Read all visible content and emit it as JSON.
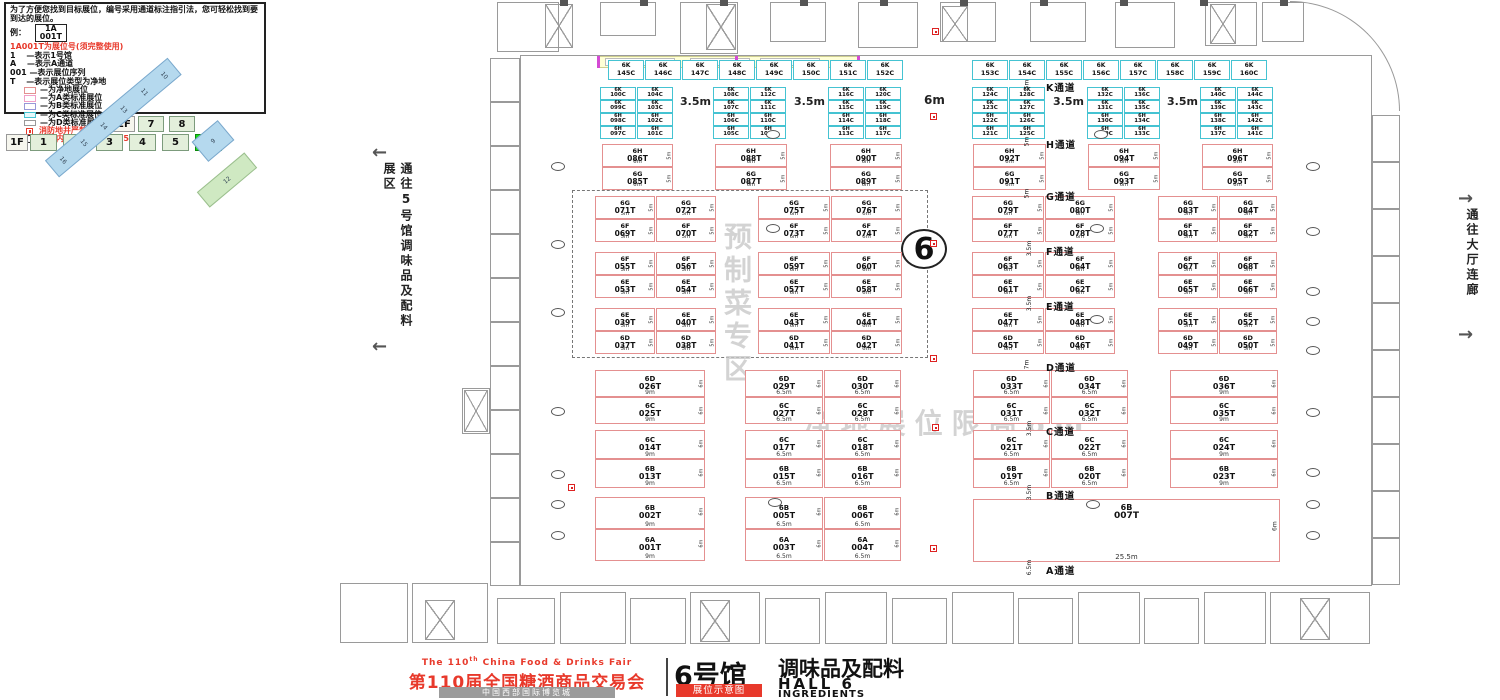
{
  "legend": {
    "intro": "为了方便您找到目标展位，编号采用通道标注指引法，您可轻松找到要到达的展位。",
    "example_label": "例：",
    "example_top": "1A",
    "example_bottom": "001T",
    "rule_title": "1A001T为展位号(须完整使用)",
    "rules": [
      "1　 —表示1号馆",
      "A　 —表示A通道",
      "001 —表示展位序列",
      "T　 —表示展位类型为净地"
    ],
    "swatches": [
      {
        "label": "—为净地展位",
        "border": "#e49090",
        "bg": "#ffffff"
      },
      {
        "label": "—为A类标准展位",
        "border": "#f0a0c8",
        "bg": "#ffffff"
      },
      {
        "label": "—为B类标准展位",
        "border": "#9898d8",
        "bg": "#ffffff"
      },
      {
        "label": "—为C类标准展位",
        "border": "#45c3d2",
        "bg": "#e4f9fb"
      },
      {
        "label": "—为D类标准展位",
        "border": "#999999",
        "bg": "#ffffff"
      }
    ],
    "fire_note": "消防地井严禁遮挡",
    "pillar_note": "展位内立柱 直径均为1.5m"
  },
  "floor_selector": {
    "f2_label": "2F",
    "f2_tabs": [
      "7",
      "8"
    ],
    "f1_label": "1F",
    "f1_tabs": [
      "1",
      "2",
      "3",
      "4",
      "5",
      "6"
    ],
    "active": "6"
  },
  "minimap": {
    "bar_labels": [
      "16",
      "15",
      "14",
      "13",
      "11",
      "10"
    ],
    "diamond_label": "9",
    "green_label": "12"
  },
  "side_labels": {
    "left": "通往5号馆调味品及配料展区",
    "right": "通往大厅连廊"
  },
  "watermarks": {
    "zone": "预制菜专区",
    "limit": "净地展位限高6m"
  },
  "hall_circle": "6",
  "footer": {
    "fair_en_a": "The 110",
    "fair_en_sup": "th",
    "fair_en_b": " China Food & Drinks Fair",
    "fair_cn": "第110届全国糖酒商品交易会",
    "venue": "中国西部国际博览城",
    "hall_cn": "6号馆",
    "hall_sub": "调味品及配料",
    "badge": "展位示意图",
    "hall_en": "HALL 6",
    "hall_en2": "INGREDIENTS"
  },
  "plan": {
    "cyan_top": {
      "y": 60,
      "h": 20,
      "w": 36,
      "gap": 1,
      "rows": [
        {
          "x": 608,
          "ids": [
            "6K 145C",
            "6K 146C",
            "6K 147C",
            "6K 148C",
            "6K 149C",
            "6K 150C",
            "6K 151C",
            "6K 152C"
          ]
        },
        {
          "x": 972,
          "ids": [
            "6K 153C",
            "6K 154C",
            "6K 155C",
            "6K 156C",
            "6K 157C",
            "6K 158C",
            "6K 159C",
            "6K 160C"
          ]
        }
      ]
    },
    "cyan_groups": {
      "y": 87,
      "rowH": 13,
      "colW": 36,
      "gap": 1,
      "groups": [
        {
          "x": 600,
          "cells": [
            [
              "6K 100C",
              "6K 104C"
            ],
            [
              "6K 099C",
              "6K 103C"
            ],
            [
              "6H 098C",
              "6H 102C"
            ],
            [
              "6H 097C",
              "6H 101C"
            ]
          ]
        },
        {
          "x": 713,
          "cells": [
            [
              "6K 108C",
              "6K 112C"
            ],
            [
              "6K 107C",
              "6K 111C"
            ],
            [
              "6H 106C",
              "6H 110C"
            ],
            [
              "6H 105C",
              "6H 109C"
            ]
          ]
        },
        {
          "x": 828,
          "cells": [
            [
              "6K 116C",
              "6K 120C"
            ],
            [
              "6K 115C",
              "6K 119C"
            ],
            [
              "6H 114C",
              "6H 118C"
            ],
            [
              "6H 113C",
              "6H 117C"
            ]
          ]
        },
        {
          "x": 972,
          "cells": [
            [
              "6K 124C",
              "6K 128C"
            ],
            [
              "6K 123C",
              "6K 127C"
            ],
            [
              "6H 122C",
              "6H 126C"
            ],
            [
              "6H 121C",
              "6H 125C"
            ]
          ]
        },
        {
          "x": 1087,
          "cells": [
            [
              "6K 132C",
              "6K 136C"
            ],
            [
              "6K 131C",
              "6K 135C"
            ],
            [
              "6H 130C",
              "6H 134C"
            ],
            [
              "6H 129C",
              "6H 133C"
            ]
          ]
        },
        {
          "x": 1200,
          "cells": [
            [
              "6K 140C",
              "6K 144C"
            ],
            [
              "6K 139C",
              "6K 143C"
            ],
            [
              "6H 138C",
              "6H 142C"
            ],
            [
              "6H 137C",
              "6H 141C"
            ]
          ]
        }
      ]
    },
    "gap_dims": [
      {
        "x": 680,
        "y": 95,
        "t": "3.5m"
      },
      {
        "x": 794,
        "y": 95,
        "t": "3.5m"
      },
      {
        "x": 924,
        "y": 93,
        "t": "6m"
      },
      {
        "x": 1053,
        "y": 95,
        "t": "3.5m"
      },
      {
        "x": 1167,
        "y": 95,
        "t": "3.5m"
      }
    ],
    "red_bands": [
      {
        "y": 144,
        "cellH": 23,
        "cols": [
          [
            602,
            71,
            "6H 086T",
            "6G 085T",
            "6m",
            "5m"
          ],
          [
            715,
            72,
            "6H 088T",
            "6G 087T",
            "6m",
            "5m"
          ],
          [
            830,
            72,
            "6H 090T",
            "6G 089T",
            "6m",
            "5m"
          ],
          [
            973,
            73,
            "6H 092T",
            "6G 091T",
            "6m",
            "5m"
          ],
          [
            1088,
            72,
            "6H 094T",
            "6G 093T",
            "6m",
            "5m"
          ],
          [
            1202,
            71,
            "6H 096T",
            "6G 095T",
            "6m",
            "5m"
          ]
        ]
      },
      {
        "y": 196,
        "cellH": 23,
        "cols": [
          [
            595,
            60,
            "6G 071T",
            "6F 069T",
            "5m",
            "5m"
          ],
          [
            656,
            60,
            "6G 072T",
            "6F 070T",
            "5m",
            "5m"
          ],
          [
            758,
            72,
            "6G 075T",
            "6F 073T",
            "6m",
            "5m"
          ],
          [
            831,
            71,
            "6G 076T",
            "6F 074T",
            "6m",
            "5m"
          ],
          [
            972,
            72,
            "6G 079T",
            "6F 077T",
            "6m",
            "5m"
          ],
          [
            1045,
            70,
            "6G 080T",
            "6F 078T",
            "6m",
            "5m"
          ],
          [
            1158,
            60,
            "6G 083T",
            "6F 081T",
            "5m",
            "5m"
          ],
          [
            1219,
            58,
            "6G 084T",
            "6F 082T",
            "5m",
            "5m"
          ]
        ]
      },
      {
        "y": 252,
        "cellH": 23,
        "cols": [
          [
            595,
            60,
            "6F 055T",
            "6E 053T",
            "5m",
            "5m"
          ],
          [
            656,
            60,
            "6F 056T",
            "6E 054T",
            "5m",
            "5m"
          ],
          [
            758,
            72,
            "6F 059T",
            "6E 057T",
            "6m",
            "5m"
          ],
          [
            831,
            71,
            "6F 060T",
            "6E 058T",
            "6m",
            "5m"
          ],
          [
            972,
            72,
            "6F 063T",
            "6E 061T",
            "6m",
            "5m"
          ],
          [
            1045,
            70,
            "6F 064T",
            "6E 062T",
            "6m",
            "5m"
          ],
          [
            1158,
            60,
            "6F 067T",
            "6E 065T",
            "5m",
            "5m"
          ],
          [
            1219,
            58,
            "6F 068T",
            "6E 066T",
            "5m",
            "5m"
          ]
        ]
      },
      {
        "y": 308,
        "cellH": 23,
        "cols": [
          [
            595,
            60,
            "6E 039T",
            "6D 037T",
            "5m",
            "5m"
          ],
          [
            656,
            60,
            "6E 040T",
            "6D 038T",
            "5m",
            "5m"
          ],
          [
            758,
            72,
            "6E 043T",
            "6D 041T",
            "6m",
            "5m"
          ],
          [
            831,
            71,
            "6E 044T",
            "6D 042T",
            "6m",
            "5m"
          ],
          [
            972,
            72,
            "6E 047T",
            "6D 045T",
            "6m",
            "5m"
          ],
          [
            1045,
            70,
            "6E 048T",
            "6D 046T",
            "6m",
            "5m"
          ],
          [
            1158,
            60,
            "6E 051T",
            "6D 049T",
            "5m",
            "5m"
          ],
          [
            1219,
            58,
            "6E 052T",
            "6D 050T",
            "5m",
            "5m"
          ]
        ]
      },
      {
        "y": 370,
        "cellH": 27,
        "cols": [
          [
            595,
            110,
            "6D 026T",
            "6C 025T",
            "9m",
            "6m"
          ],
          [
            745,
            78,
            "6D 029T",
            "6C 027T",
            "6.5m",
            "6m"
          ],
          [
            824,
            77,
            "6D 030T",
            "6C 028T",
            "6.5m",
            "6m"
          ],
          [
            973,
            77,
            "6D 033T",
            "6C 031T",
            "6.5m",
            "6m"
          ],
          [
            1051,
            77,
            "6D 034T",
            "6C 032T",
            "6.5m",
            "6m"
          ],
          [
            1170,
            108,
            "6D 036T",
            "6C 035T",
            "9m",
            "6m"
          ]
        ]
      },
      {
        "y": 430,
        "cellH": 29,
        "cols": [
          [
            595,
            110,
            "6C 014T",
            "6B 013T",
            "9m",
            "6m"
          ],
          [
            745,
            78,
            "6C 017T",
            "6B 015T",
            "6.5m",
            "6m"
          ],
          [
            824,
            77,
            "6C 018T",
            "6B 016T",
            "6.5m",
            "6m"
          ],
          [
            973,
            77,
            "6C 021T",
            "6B 019T",
            "6.5m",
            "6m"
          ],
          [
            1051,
            77,
            "6C 022T",
            "6B 020T",
            "6.5m",
            "6m"
          ],
          [
            1170,
            108,
            "6C 024T",
            "6B 023T",
            "9m",
            "6m"
          ]
        ]
      },
      {
        "y": 497,
        "cellH": 32,
        "cols": [
          [
            595,
            110,
            "6B 002T",
            "6A 001T",
            "9m",
            "6m"
          ],
          [
            745,
            78,
            "6B 005T",
            "6A 003T",
            "6.5m",
            "6m"
          ],
          [
            824,
            77,
            "6B 006T",
            "6A 004T",
            "6.5m",
            "6m"
          ]
        ]
      }
    ],
    "big_booth": {
      "x": 973,
      "y": 499,
      "w": 307,
      "h": 63,
      "id": "6B 007T",
      "wl": "25.5m",
      "side": "6m"
    },
    "aisles": [
      {
        "y": 80,
        "label": "K通道",
        "dim": "5m"
      },
      {
        "y": 137,
        "label": "H通道",
        "dim": "5m"
      },
      {
        "y": 189,
        "label": "G通道",
        "dim": "5m"
      },
      {
        "y": 244,
        "label": "F通道",
        "dim": "3.5m"
      },
      {
        "y": 299,
        "label": "E通道",
        "dim": "3.5m"
      },
      {
        "y": 360,
        "label": "D通道",
        "dim": "7m"
      },
      {
        "y": 424,
        "label": "C通道",
        "dim": "3.5m"
      },
      {
        "y": 488,
        "label": "B通道",
        "dim": "3.5m"
      },
      {
        "y": 563,
        "label": "A通道",
        "dim": "6.5m"
      }
    ],
    "dashed_zone": {
      "x": 572,
      "y": 190,
      "w": 356,
      "h": 168
    },
    "pillars": [
      [
        551,
        162
      ],
      [
        551,
        240
      ],
      [
        551,
        308
      ],
      [
        551,
        407
      ],
      [
        551,
        470
      ],
      [
        551,
        500
      ],
      [
        551,
        531
      ],
      [
        1306,
        162
      ],
      [
        1306,
        227
      ],
      [
        1306,
        287
      ],
      [
        1306,
        317
      ],
      [
        1306,
        346
      ],
      [
        1306,
        408
      ],
      [
        1306,
        468
      ],
      [
        1306,
        500
      ],
      [
        1306,
        531
      ],
      [
        766,
        130
      ],
      [
        1094,
        130
      ],
      [
        766,
        224
      ],
      [
        1090,
        224
      ],
      [
        1090,
        315
      ],
      [
        768,
        498
      ],
      [
        1086,
        500
      ]
    ],
    "fires": [
      [
        932,
        28
      ],
      [
        930,
        113
      ],
      [
        930,
        240
      ],
      [
        930,
        355
      ],
      [
        932,
        424
      ],
      [
        930,
        545
      ],
      [
        568,
        484
      ]
    ]
  }
}
